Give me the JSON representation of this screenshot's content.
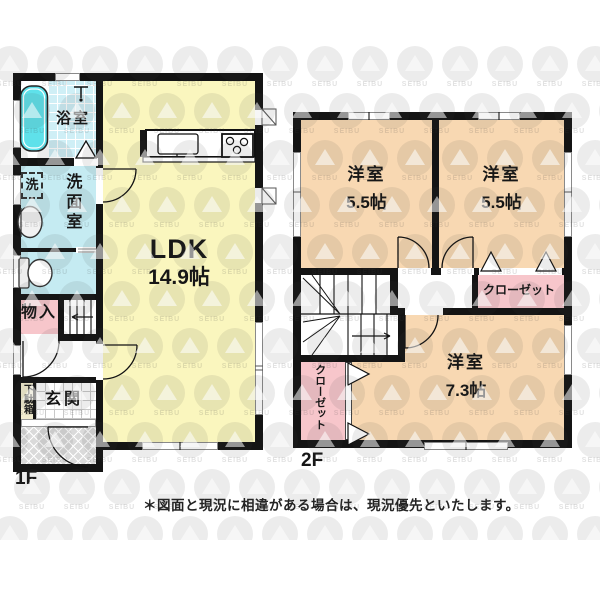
{
  "disclaimer": "＊図面と現況に相違がある場合は、現況優先といたします。",
  "watermark": {
    "text": "SEIBU"
  },
  "floor1": {
    "label": "1F",
    "ldk": {
      "name": "LDK",
      "size": "14.9帖"
    },
    "bath": {
      "name": "浴室"
    },
    "washroom": {
      "name": "洗面室"
    },
    "laundry": {
      "name": "洗"
    },
    "storage": {
      "name": "物入"
    },
    "shoe_cabinet": {
      "name": "下駄箱"
    },
    "entrance": {
      "name": "玄関"
    }
  },
  "floor2": {
    "label": "2F",
    "bedroom_a": {
      "name": "洋室",
      "size": "5.5帖"
    },
    "bedroom_b": {
      "name": "洋室",
      "size": "5.5帖"
    },
    "bedroom_c": {
      "name": "洋室",
      "size": "7.3帖"
    },
    "closet_a": {
      "name": "クローゼット"
    },
    "closet_b": {
      "name": "クローゼット"
    }
  },
  "colors": {
    "ldk_yellow": "#FAF6BE",
    "bedroom_peach": "#F8D8B2",
    "closet_pink": "#F7C6CB",
    "wet_area_cyan": "#C5EBF2",
    "bathtub_cyan": "#5FE1EA",
    "wall_black": "#141414"
  }
}
